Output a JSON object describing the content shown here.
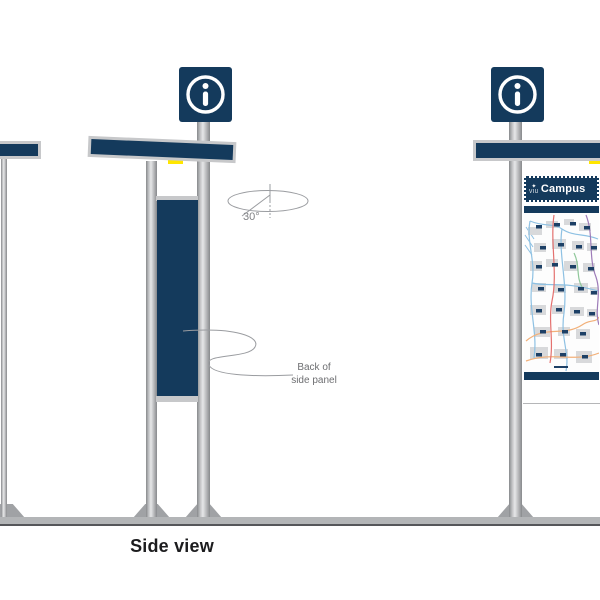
{
  "view": {
    "label": "Side view"
  },
  "rotation_annotation": {
    "angle": "30°"
  },
  "panel_annotation": {
    "line1": "Back of",
    "line2": "side panel"
  },
  "map_panel": {
    "logo": "VIU",
    "title": "Campus"
  },
  "icons": {
    "info": "info-circle-i"
  },
  "colors": {
    "navy": "#143A5C",
    "pole_silver": "#C2C3C5",
    "accent_yellow": "#FFE600",
    "ground_gray": "#B3B5B7",
    "annotation_gray": "#6D6E71",
    "building_gray": "#D8D9DB",
    "road_blue": "#8EC1E3",
    "road_orange": "#F2B079",
    "road_red": "#E4716F",
    "road_purple": "#9D7BB8",
    "road_green": "#8FC79A"
  }
}
